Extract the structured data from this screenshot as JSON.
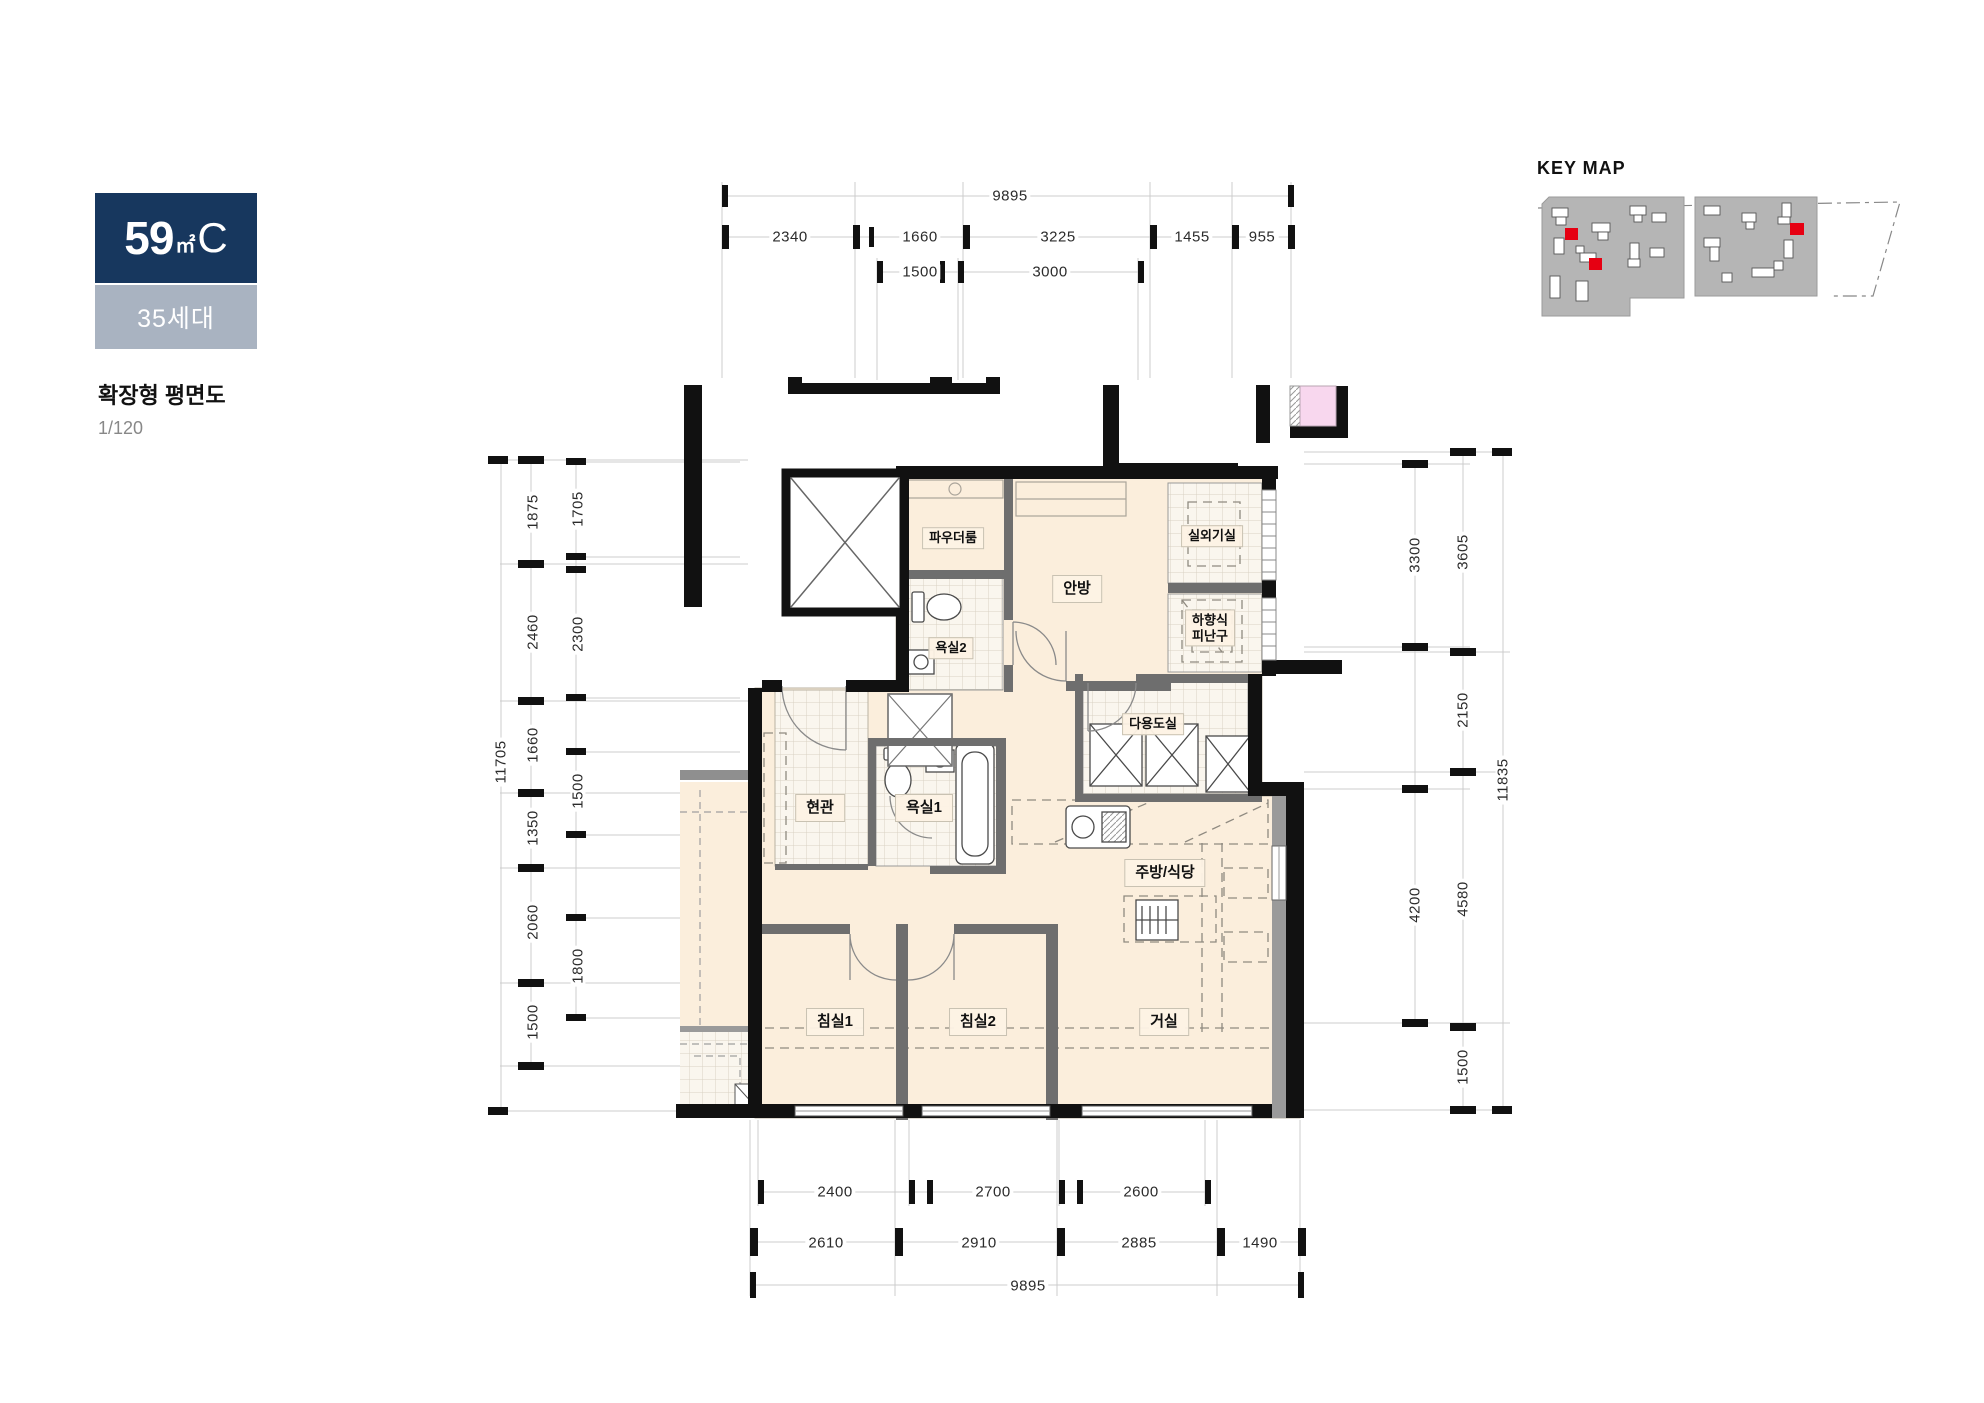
{
  "badge": {
    "area_value": "59",
    "area_unit": "㎡",
    "area_type": "C",
    "households": "35세대"
  },
  "title": {
    "plan_type": "확장형 평면도",
    "scale": "1/120"
  },
  "key_map": {
    "label": "KEY MAP"
  },
  "rooms": {
    "powder_room": "파우더룸",
    "master_bedroom": "안방",
    "ac_unit_room": "실외기실",
    "escape_hatch_line1": "하향식",
    "escape_hatch_line2": "피난구",
    "bathroom2": "욕실2",
    "utility_room": "다용도실",
    "entrance": "현관",
    "bathroom1": "욕실1",
    "kitchen_dining": "주방/식당",
    "bedroom1": "침실1",
    "bedroom2": "침실2",
    "living_room": "거실"
  },
  "dims": {
    "top": {
      "total": "9895",
      "row2": [
        "2340",
        "1660",
        "3225",
        "1455",
        "955"
      ],
      "row3": [
        "1500",
        "3000"
      ]
    },
    "bottom": {
      "row1": [
        "2400",
        "2700",
        "2600"
      ],
      "row2": [
        "2610",
        "2910",
        "2885",
        "1490"
      ],
      "total": "9895"
    },
    "left": {
      "total": "11705",
      "outer": [
        "1875",
        "2460",
        "1660",
        "1350",
        "2060",
        "1500"
      ],
      "inner": [
        "1705",
        "2300",
        "1500",
        "1800"
      ]
    },
    "right": {
      "total": "11835",
      "inner": [
        "3300",
        "4200"
      ],
      "outer": [
        "3605",
        "2150",
        "4580",
        "1500"
      ]
    }
  },
  "colors": {
    "badge_navy": "#17375E",
    "badge_gray": "#A9B3C1",
    "floor_cream": "#FBEEDC",
    "neighbor_pink": "#F8D7EE",
    "keymap_red": "#E60012",
    "wall_black": "#111111"
  }
}
